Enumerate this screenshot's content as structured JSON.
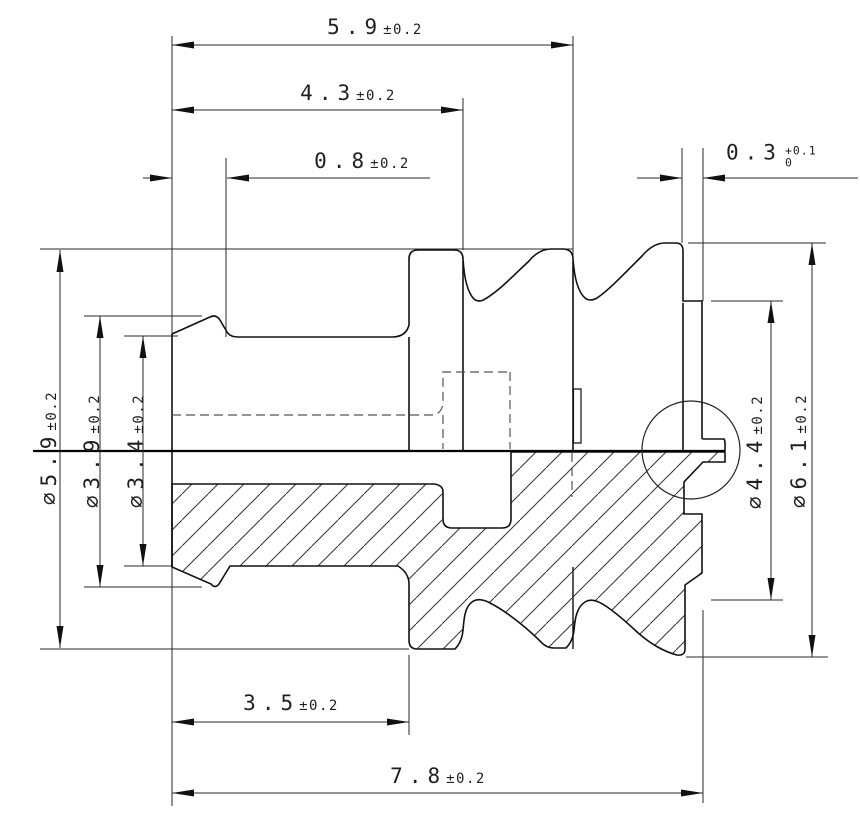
{
  "colors": {
    "line": "#1c1c1c",
    "background": "#ffffff"
  },
  "dimensions": {
    "length_59": {
      "value": "5.9",
      "tol": "±0.2"
    },
    "length_43": {
      "value": "4.3",
      "tol": "±0.2"
    },
    "length_08": {
      "value": "0.8",
      "tol": "±0.2"
    },
    "length_03": {
      "value": "0.3",
      "tol_plus": "+0.1",
      "tol_minus": "0"
    },
    "length_35": {
      "value": "3.5",
      "tol": "±0.2"
    },
    "length_78": {
      "value": "7.8",
      "tol": "±0.2"
    },
    "dia_59": {
      "value": "∅5.9",
      "tol": "±0.2"
    },
    "dia_39": {
      "value": "∅3.9",
      "tol": "±0.2"
    },
    "dia_34": {
      "value": "∅3.4",
      "tol": "±0.2"
    },
    "dia_44": {
      "value": "∅4.4",
      "tol": "±0.2"
    },
    "dia_61": {
      "value": "∅6.1",
      "tol": "±0.2"
    }
  }
}
